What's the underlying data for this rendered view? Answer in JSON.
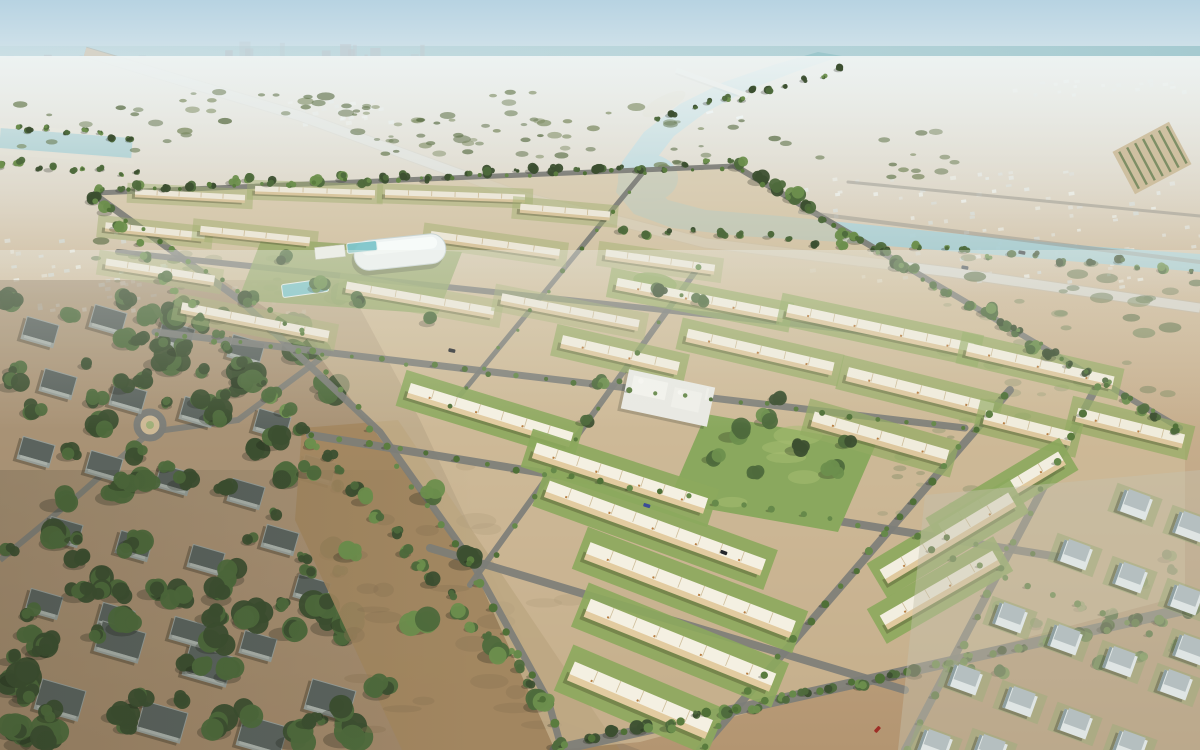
{
  "scene": {
    "description": "Aerial 3D rendering of a desert residential masterplan community with rows of cream townhouses, palm-lined streets, a central park and mosque, a white sports dome, surrounded by existing villa neighbourhoods, sand fields, a teal creek and a hazy city skyline on the horizon",
    "width": 1200,
    "height": 750
  },
  "palette": {
    "skyTop": "#b7d3e2",
    "skyHorizon": "#ecf2f1",
    "sea": "#a3c9cf",
    "sand1": "#dad2c2",
    "sand2": "#cdb897",
    "sand3": "#c0a584",
    "sand4": "#b39571",
    "planSand": "#d4c2a0",
    "dirtField": "#a2865f",
    "dirtLeft": "#8f7c62",
    "dirtMottle": "#8a7252",
    "road": "#7d7e78",
    "roadFaint": "#9a9a92",
    "highway": "#d6d3c8",
    "waterCreek": "#9cc6cb",
    "waterChannel": "#70acb0",
    "waterPool": "#7fc6cb",
    "lawn": [
      "#9fb06e",
      "#93ab62",
      "#8ca95d",
      "#8ca95d"
    ],
    "lawnOpacity": [
      0.45,
      0.7,
      0.9,
      0.9
    ],
    "treeDark": "#3c4f30",
    "treeMid": "#4e6a3c",
    "treeLight": "#6d8f4d",
    "palm": [
      "#5a7c3e",
      "#66894a",
      "#4f7037"
    ],
    "shrub": [
      "#6f815a",
      "#5d7048",
      "#7b8a60"
    ],
    "roofs": [
      "#ece7d8",
      "#f0ecdc",
      "#f4f0e2",
      "#f2eee0"
    ],
    "walls": [
      "#d9c69f",
      "#ddc79e",
      "#e2cba0",
      "#e0c99e"
    ],
    "unitTick": "#c6b289",
    "unitAccent": "#b0702f",
    "villaLeftWall": "#969d97",
    "villaLeftRoof": "#5b635e",
    "villaRightWall": "#dfe5e4",
    "villaRightRoof": "#b5bfc0",
    "villaRightSide": "#8fa0a2",
    "skyline": "#c4ced4",
    "suburbBox": [
      "#edefe9",
      "#dfe3de",
      "#cfd6d2"
    ],
    "white": "#f2f2ec",
    "domeWhite": "#eef3f2"
  },
  "skyline": {
    "x0": 5,
    "x1": 600,
    "base": 72,
    "n": 72,
    "hMin": 5,
    "hMax": 26,
    "tallZone": [
      220,
      430
    ]
  },
  "groundPolys": {
    "plan": [
      [
        90,
        195
      ],
      [
        740,
        165
      ],
      [
        1185,
        435
      ],
      [
        1185,
        595
      ],
      [
        640,
        742
      ],
      [
        555,
        750
      ],
      [
        470,
        560
      ],
      [
        300,
        330
      ]
    ],
    "leftHood": [
      [
        0,
        280
      ],
      [
        345,
        280
      ],
      [
        420,
        420
      ],
      [
        560,
        720
      ],
      [
        640,
        750
      ],
      [
        0,
        750
      ]
    ],
    "dirtField": [
      [
        302,
        428
      ],
      [
        398,
        420
      ],
      [
        620,
        750
      ],
      [
        402,
        750
      ],
      [
        295,
        520
      ]
    ],
    "rightDistrict": [
      [
        925,
        495
      ],
      [
        1200,
        470
      ],
      [
        1200,
        750
      ],
      [
        898,
        750
      ]
    ]
  },
  "waters": {
    "creek": [
      [
        842,
        56
      ],
      [
        795,
        72
      ],
      [
        748,
        90
      ],
      [
        706,
        112
      ],
      [
        674,
        136
      ],
      [
        654,
        162
      ],
      [
        650,
        184
      ],
      [
        668,
        200
      ],
      [
        706,
        210
      ],
      [
        780,
        216
      ],
      [
        880,
        226
      ],
      [
        1000,
        238
      ],
      [
        1100,
        247
      ],
      [
        1200,
        254
      ],
      [
        1200,
        272
      ],
      [
        1080,
        262
      ],
      [
        960,
        252
      ],
      [
        840,
        242
      ],
      [
        740,
        236
      ],
      [
        672,
        228
      ],
      [
        634,
        214
      ],
      [
        616,
        192
      ],
      [
        622,
        162
      ],
      [
        644,
        132
      ],
      [
        680,
        104
      ],
      [
        724,
        82
      ],
      [
        776,
        64
      ],
      [
        818,
        52
      ]
    ],
    "pool": [
      648,
      178,
      30,
      24
    ],
    "islands": [
      [
        664,
        104,
        24,
        8,
        -28
      ],
      [
        700,
        176,
        12,
        5,
        -10
      ]
    ],
    "leftChannel": [
      0,
      138,
      132,
      148,
      20
    ],
    "bridge": [
      676,
      70,
      748,
      96
    ],
    "boats": [
      [
        706,
        112
      ],
      [
        736,
        117
      ]
    ]
  },
  "highway": {
    "pts": [
      [
        85,
        52
      ],
      [
        300,
        116
      ],
      [
        520,
        196
      ],
      [
        705,
        243
      ],
      [
        950,
        272
      ],
      [
        1200,
        308
      ]
    ],
    "w": 9
  },
  "roads": [
    {
      "pts": [
        [
          95,
          193
        ],
        [
          735,
          166
        ]
      ],
      "w": 5
    },
    {
      "pts": [
        [
          735,
          166
        ],
        [
          1180,
          428
        ]
      ],
      "w": 6
    },
    {
      "pts": [
        [
          95,
          195
        ],
        [
          240,
          300
        ],
        [
          380,
          432
        ],
        [
          472,
          562
        ],
        [
          548,
          700
        ],
        [
          562,
          750
        ]
      ],
      "w": 7
    },
    {
      "pts": [
        [
          118,
          252
        ],
        [
          870,
          332
        ]
      ],
      "w": 6
    },
    {
      "pts": [
        [
          155,
          332
        ],
        [
          965,
          428
        ]
      ],
      "w": 7
    },
    {
      "pts": [
        [
          310,
          435
        ],
        [
          1065,
          558
        ]
      ],
      "w": 8
    },
    {
      "pts": [
        [
          430,
          548
        ],
        [
          905,
          690
        ]
      ],
      "w": 8
    },
    {
      "pts": [
        [
          555,
          750
        ],
        [
          1200,
          606
        ]
      ],
      "w": 11
    },
    {
      "pts": [
        [
          645,
          170
        ],
        [
          448,
          410
        ]
      ],
      "w": 5
    },
    {
      "pts": [
        [
          700,
          265
        ],
        [
          470,
          585
        ]
      ],
      "w": 6
    },
    {
      "pts": [
        [
          1010,
          390
        ],
        [
          700,
          750
        ]
      ],
      "w": 8
    },
    {
      "pts": [
        [
          1100,
          380
        ],
        [
          905,
          750
        ]
      ],
      "w": 8
    },
    {
      "pts": [
        [
          0,
          560
        ],
        [
          80,
          494
        ],
        [
          150,
          432
        ],
        [
          238,
          420
        ],
        [
          332,
          350
        ]
      ],
      "w": 6
    },
    {
      "pts": [
        [
          800,
          212
        ],
        [
          1200,
          262
        ]
      ],
      "w": 4
    },
    {
      "pts": [
        [
          848,
          182
        ],
        [
          1200,
          216
        ]
      ],
      "w": 3
    }
  ],
  "roundabout": {
    "x": 150,
    "y": 425,
    "r": 13
  },
  "suburbBands": [
    {
      "x": 790,
      "y": 168,
      "w": 410,
      "h": 118,
      "n": 95
    },
    {
      "x": 280,
      "y": 100,
      "w": 110,
      "h": 24,
      "n": 22
    },
    {
      "x": 0,
      "y": 214,
      "w": 170,
      "h": 70,
      "n": 30
    },
    {
      "x": 1000,
      "y": 78,
      "w": 200,
      "h": 16,
      "n": 20
    },
    {
      "x": 0,
      "y": 282,
      "w": 330,
      "h": 30,
      "n": 20
    }
  ],
  "shrubBands": [
    {
      "x": 0,
      "y": 92,
      "w": 640,
      "h": 62,
      "n": 55,
      "s": 6
    },
    {
      "x": 660,
      "y": 118,
      "w": 300,
      "h": 60,
      "n": 30,
      "s": 5
    },
    {
      "x": 940,
      "y": 255,
      "w": 260,
      "h": 175,
      "n": 42,
      "s": 8
    },
    {
      "x": 80,
      "y": 238,
      "w": 200,
      "h": 55,
      "n": 18,
      "s": 6
    },
    {
      "x": 360,
      "y": 118,
      "w": 260,
      "h": 40,
      "n": 22,
      "s": 5
    },
    {
      "x": 865,
      "y": 430,
      "w": 120,
      "h": 90,
      "n": 14,
      "s": 7
    },
    {
      "x": 300,
      "y": 95,
      "w": 80,
      "h": 25,
      "n": 8,
      "s": 4
    }
  ],
  "dirtMottle": {
    "x": 310,
    "y": 440,
    "w": 260,
    "h": 290,
    "n": 26
  },
  "treeScatters": [
    {
      "x": 0,
      "y": 288,
      "w": 345,
      "h": 440,
      "n": 85,
      "rMin": 7,
      "rMax": 16,
      "tone": "dark"
    },
    {
      "x": 0,
      "y": 570,
      "w": 370,
      "h": 180,
      "n": 30,
      "rMin": 10,
      "rMax": 20,
      "tone": "dark"
    },
    {
      "x": 930,
      "y": 500,
      "w": 270,
      "h": 250,
      "n": 16,
      "rMin": 5,
      "rMax": 9,
      "tone": "mid"
    }
  ],
  "treeBands": [
    [
      100,
      188,
      730,
      164,
      30,
      5
    ],
    [
      740,
      168,
      1175,
      428,
      26,
      7
    ],
    [
      95,
      198,
      545,
      700,
      34,
      7
    ],
    [
      560,
      746,
      1190,
      612,
      24,
      7
    ],
    [
      620,
      228,
      1190,
      268,
      24,
      5
    ],
    [
      660,
      120,
      836,
      68,
      12,
      4
    ],
    [
      0,
      128,
      130,
      138,
      9,
      4
    ],
    [
      0,
      164,
      140,
      174,
      9,
      4
    ]
  ],
  "treeClusters": [
    [
      735,
      432,
      12
    ],
    [
      768,
      418,
      10
    ],
    [
      800,
      446,
      11
    ],
    [
      832,
      470,
      10
    ],
    [
      714,
      456,
      9
    ],
    [
      758,
      472,
      8
    ],
    [
      846,
      442,
      8
    ],
    [
      780,
      396,
      9
    ],
    [
      430,
      492,
      15
    ],
    [
      468,
      558,
      14
    ],
    [
      420,
      620,
      17
    ],
    [
      498,
      650,
      15
    ],
    [
      382,
      688,
      14
    ],
    [
      540,
      702,
      12
    ],
    [
      350,
      552,
      12
    ],
    [
      310,
      470,
      10
    ],
    [
      600,
      382,
      8
    ],
    [
      585,
      420,
      7
    ],
    [
      285,
      258,
      8
    ],
    [
      320,
      285,
      9
    ],
    [
      360,
      300,
      8
    ],
    [
      250,
      300,
      9
    ],
    [
      430,
      320,
      8
    ],
    [
      700,
      300,
      7
    ],
    [
      660,
      290,
      7
    ]
  ],
  "palmLines": [
    [
      95,
      200,
      300,
      332,
      14,
      2.4
    ],
    [
      300,
      332,
      470,
      562,
      13,
      3
    ],
    [
      470,
      562,
      556,
      722,
      8,
      3.6
    ],
    [
      100,
      190,
      720,
      167,
      24,
      2
    ],
    [
      565,
      744,
      1190,
      612,
      23,
      4
    ],
    [
      1005,
      395,
      705,
      745,
      21,
      3.4
    ],
    [
      1096,
      386,
      908,
      748,
      15,
      3.4
    ],
    [
      158,
      334,
      962,
      428,
      30,
      2.4
    ],
    [
      312,
      436,
      1062,
      558,
      27,
      2.8
    ],
    [
      646,
      172,
      450,
      408,
      13,
      2
    ],
    [
      700,
      266,
      474,
      584,
      12,
      2.4
    ],
    [
      930,
      548,
      1198,
      652,
      12,
      3
    ],
    [
      742,
      170,
      1176,
      426,
      20,
      2.2
    ]
  ],
  "townhouseRows": [
    [
      190,
      196,
      110,
      8,
      3,
      0
    ],
    [
      315,
      192,
      120,
      8,
      2,
      0
    ],
    [
      455,
      196,
      140,
      8,
      2,
      0
    ],
    [
      565,
      212,
      90,
      9,
      5,
      0
    ],
    [
      155,
      232,
      100,
      9,
      6,
      0
    ],
    [
      255,
      236,
      110,
      9,
      6,
      0
    ],
    [
      495,
      245,
      130,
      10,
      8,
      0
    ],
    [
      660,
      262,
      110,
      10,
      8,
      0
    ],
    [
      160,
      272,
      110,
      10,
      9,
      0
    ],
    [
      420,
      300,
      150,
      11,
      10,
      0
    ],
    [
      570,
      312,
      140,
      11,
      11,
      0
    ],
    [
      255,
      322,
      150,
      11,
      11,
      0
    ],
    [
      700,
      300,
      170,
      12,
      11,
      1
    ],
    [
      880,
      330,
      190,
      13,
      12,
      1
    ],
    [
      1040,
      366,
      150,
      13,
      13,
      1
    ],
    [
      760,
      352,
      150,
      13,
      13,
      1
    ],
    [
      920,
      392,
      150,
      14,
      14,
      1
    ],
    [
      1130,
      428,
      110,
      14,
      14,
      1
    ],
    [
      620,
      355,
      120,
      13,
      13,
      1
    ],
    [
      880,
      438,
      140,
      15,
      16,
      1
    ],
    [
      1028,
      428,
      90,
      14,
      14,
      1
    ],
    [
      490,
      415,
      170,
      15,
      17,
      2
    ],
    [
      620,
      478,
      180,
      16,
      18,
      2
    ],
    [
      655,
      528,
      230,
      17,
      20,
      2
    ],
    [
      690,
      590,
      220,
      18,
      21,
      2
    ],
    [
      680,
      645,
      200,
      19,
      22,
      2
    ],
    [
      640,
      700,
      150,
      20,
      23,
      2
    ],
    [
      948,
      538,
      150,
      16,
      -31,
      3
    ],
    [
      1002,
      494,
      140,
      15,
      -31,
      3
    ],
    [
      940,
      590,
      130,
      16,
      -30,
      3
    ]
  ],
  "villasLeft": [
    [
      40,
      332
    ],
    [
      108,
      320
    ],
    [
      176,
      336
    ],
    [
      246,
      350
    ],
    [
      58,
      384
    ],
    [
      128,
      398
    ],
    [
      198,
      412
    ],
    [
      272,
      424
    ],
    [
      36,
      452
    ],
    [
      104,
      466
    ],
    [
      174,
      480
    ],
    [
      246,
      494
    ],
    [
      64,
      532
    ],
    [
      134,
      546
    ],
    [
      206,
      560
    ],
    [
      280,
      540
    ],
    [
      44,
      604
    ],
    [
      116,
      618
    ],
    [
      188,
      632
    ],
    [
      258,
      646
    ],
    [
      312,
      590
    ],
    [
      318,
      470
    ]
  ],
  "villasLeftBig": [
    [
      120,
      642
    ],
    [
      208,
      666
    ],
    [
      60,
      700
    ],
    [
      162,
      722
    ],
    [
      262,
      736
    ],
    [
      330,
      700
    ]
  ],
  "villasRight": [
    [
      1135,
      505
    ],
    [
      1190,
      527
    ],
    [
      1075,
      555
    ],
    [
      1130,
      578
    ],
    [
      1185,
      600
    ],
    [
      1010,
      618
    ],
    [
      1065,
      640
    ],
    [
      1120,
      662
    ],
    [
      1175,
      685
    ],
    [
      965,
      680
    ],
    [
      1020,
      702
    ],
    [
      1075,
      724
    ],
    [
      1130,
      746
    ],
    [
      935,
      745
    ],
    [
      990,
      750
    ],
    [
      1190,
      650
    ]
  ],
  "parks": {
    "central": [
      [
        706,
        414
      ],
      [
        876,
        444
      ],
      [
        838,
        532
      ],
      [
        668,
        502
      ]
    ],
    "domePark": [
      [
        262,
        238
      ],
      [
        462,
        252
      ],
      [
        438,
        314
      ],
      [
        238,
        300
      ]
    ],
    "greenOval": [
      655,
      282,
      22,
      9,
      10
    ]
  },
  "landmarks": {
    "dome": {
      "x": 400,
      "y": 252,
      "w": 92,
      "h": 30,
      "a": -6
    },
    "clubhouse": {
      "x": 330,
      "y": 252,
      "w": 30,
      "h": 12,
      "a": -6
    },
    "pools": [
      [
        305,
        288,
        46,
        13,
        -8
      ],
      [
        362,
        247,
        30,
        10,
        -6
      ]
    ],
    "mosque": {
      "x": 668,
      "y": 398,
      "w": 88,
      "h": 40,
      "a": 12
    },
    "plantation": {
      "x": 1152,
      "y": 158,
      "w": 48,
      "h": 64,
      "a": 62
    }
  },
  "cars": [
    [
      647,
      505,
      18,
      "#3b4c97"
    ],
    [
      724,
      552,
      20,
      "#23262b"
    ],
    [
      877,
      729,
      -48,
      "#9e2e26"
    ],
    [
      1022,
      252,
      10,
      "#3c4246"
    ],
    [
      965,
      267,
      10,
      "#596064"
    ],
    [
      452,
      350,
      12,
      "#2f3133"
    ]
  ]
}
